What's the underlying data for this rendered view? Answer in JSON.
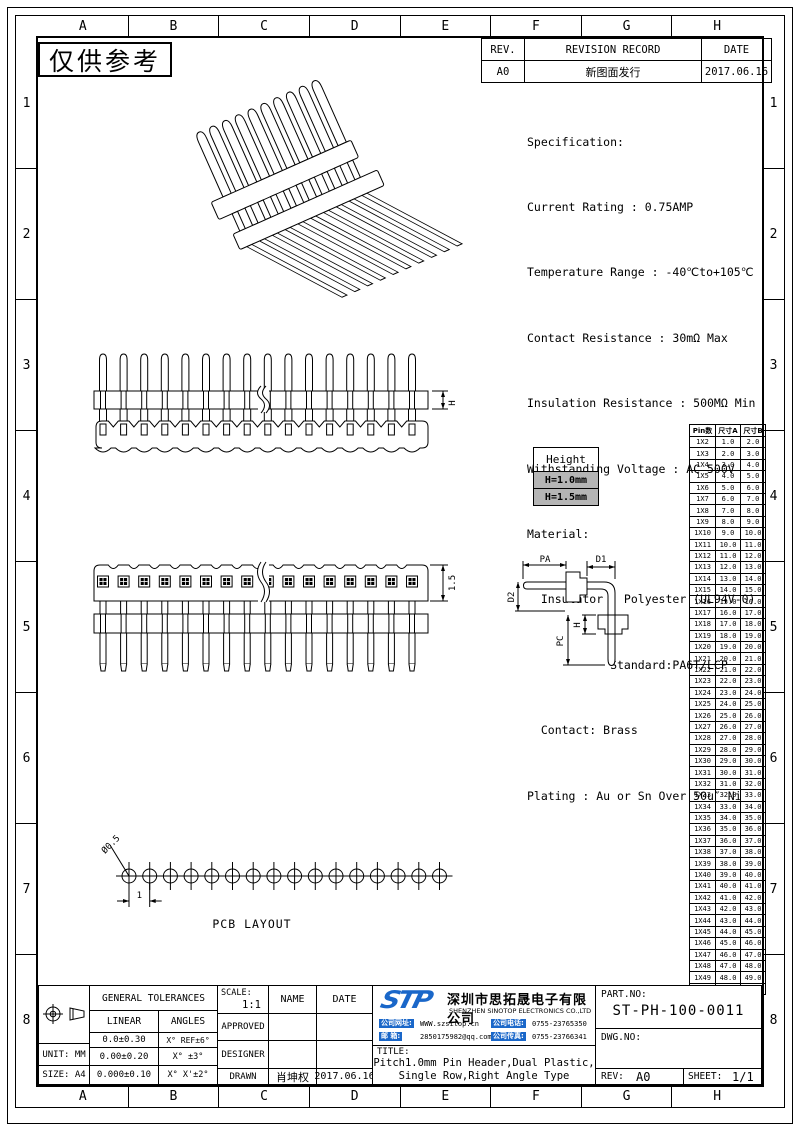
{
  "watermark": "仅供参考",
  "grid": {
    "cols": [
      "A",
      "B",
      "C",
      "D",
      "E",
      "F",
      "G",
      "H"
    ],
    "rows": [
      "1",
      "2",
      "3",
      "4",
      "5",
      "6",
      "7",
      "8"
    ]
  },
  "revision": {
    "rev_header": "REV.",
    "record_header": "REVISION RECORD",
    "date_header": "DATE",
    "rows": [
      {
        "rev": "A0",
        "record": "新图面发行",
        "date": "2017.06.16"
      }
    ]
  },
  "specification": {
    "lines": [
      "Specification:",
      "Current Rating : 0.75AMP",
      "Temperature Range : -40℃to+105℃",
      "Contact Resistance : 30mΩ Max",
      "Insulation Resistance : 500MΩ Min",
      "Withstanding Voltage : AC 500V",
      "Material:",
      "  Insulator : Polyester (UL94V-0)",
      "            Standard:PA6T/LCP",
      "  Contact: Brass",
      "Plating : Au or Sn Over 50u″ Ni"
    ]
  },
  "height_box": {
    "title": "Height",
    "options": [
      "H=1.0mm",
      "H=1.5mm"
    ]
  },
  "size_table": {
    "headers": [
      "Pin数",
      "尺寸A",
      "尺寸B"
    ],
    "rows": [
      [
        "1X2",
        "1.0",
        "2.0"
      ],
      [
        "1X3",
        "2.0",
        "3.0"
      ],
      [
        "1X4",
        "3.0",
        "4.0"
      ],
      [
        "1X5",
        "4.0",
        "5.0"
      ],
      [
        "1X6",
        "5.0",
        "6.0"
      ],
      [
        "1X7",
        "6.0",
        "7.0"
      ],
      [
        "1X8",
        "7.0",
        "8.0"
      ],
      [
        "1X9",
        "8.0",
        "9.0"
      ],
      [
        "1X10",
        "9.0",
        "10.0"
      ],
      [
        "1X11",
        "10.0",
        "11.0"
      ],
      [
        "1X12",
        "11.0",
        "12.0"
      ],
      [
        "1X13",
        "12.0",
        "13.0"
      ],
      [
        "1X14",
        "13.0",
        "14.0"
      ],
      [
        "1X15",
        "14.0",
        "15.0"
      ],
      [
        "1X16",
        "15.0",
        "16.0"
      ],
      [
        "1X17",
        "16.0",
        "17.0"
      ],
      [
        "1X18",
        "17.0",
        "18.0"
      ],
      [
        "1X19",
        "18.0",
        "19.0"
      ],
      [
        "1X20",
        "19.0",
        "20.0"
      ],
      [
        "1X21",
        "20.0",
        "21.0"
      ],
      [
        "1X22",
        "21.0",
        "22.0"
      ],
      [
        "1X23",
        "22.0",
        "23.0"
      ],
      [
        "1X24",
        "23.0",
        "24.0"
      ],
      [
        "1X25",
        "24.0",
        "25.0"
      ],
      [
        "1X26",
        "25.0",
        "26.0"
      ],
      [
        "1X27",
        "26.0",
        "27.0"
      ],
      [
        "1X28",
        "27.0",
        "28.0"
      ],
      [
        "1X29",
        "28.0",
        "29.0"
      ],
      [
        "1X30",
        "29.0",
        "30.0"
      ],
      [
        "1X31",
        "30.0",
        "31.0"
      ],
      [
        "1X32",
        "31.0",
        "32.0"
      ],
      [
        "1X33",
        "32.0",
        "33.0"
      ],
      [
        "1X34",
        "33.0",
        "34.0"
      ],
      [
        "1X35",
        "34.0",
        "35.0"
      ],
      [
        "1X36",
        "35.0",
        "36.0"
      ],
      [
        "1X37",
        "36.0",
        "37.0"
      ],
      [
        "1X38",
        "37.0",
        "38.0"
      ],
      [
        "1X39",
        "38.0",
        "39.0"
      ],
      [
        "1X40",
        "39.0",
        "40.0"
      ],
      [
        "1X41",
        "40.0",
        "41.0"
      ],
      [
        "1X42",
        "41.0",
        "42.0"
      ],
      [
        "1X43",
        "42.0",
        "43.0"
      ],
      [
        "1X44",
        "43.0",
        "44.0"
      ],
      [
        "1X45",
        "44.0",
        "45.0"
      ],
      [
        "1X46",
        "45.0",
        "46.0"
      ],
      [
        "1X47",
        "46.0",
        "47.0"
      ],
      [
        "1X48",
        "47.0",
        "48.0"
      ],
      [
        "1X49",
        "48.0",
        "49.0"
      ],
      [
        "1X50",
        "49.0",
        "50.0"
      ]
    ]
  },
  "dims": {
    "pa": "PA",
    "d1": "D1",
    "d2": "D2",
    "h": "H",
    "pc": "PC",
    "front_h": "H",
    "top_h": "1.5",
    "hole_dia": "Ø0.5",
    "pitch": "1",
    "pcb_caption": "PCB LAYOUT"
  },
  "title_block": {
    "tolerances": {
      "header": "GENERAL TOLERANCES",
      "linear": "LINEAR",
      "angles": "ANGLES",
      "linear_values": [
        "0.0±0.30",
        "0.00±0.20",
        "0.000±0.10"
      ],
      "angle_values": [
        "X° REF±6°",
        "X° ±3°",
        "X° X'±2°"
      ],
      "unit": "UNIT: MM",
      "size": "SIZE: A4"
    },
    "approval": {
      "scale_label": "SCALE:",
      "scale": "1:1",
      "name_header": "NAME",
      "date_header": "DATE",
      "approved_label": "APPROVED",
      "designer_label": "DESIGNER",
      "drawn_label": "DRAWN",
      "drawn_name": "肖坤权",
      "drawn_date": "2017.06.16"
    },
    "company": {
      "logo": "STP",
      "name_cn": "深圳市思拓晟电子有限公司",
      "name_en": "SHENZHEN SINOTOP ELECTRONICS CO.,LTD",
      "website_label": "公司网址:",
      "website": "WWW.szsitop.cn",
      "email_label": "邮  箱:",
      "email": "2850175982@qq.com",
      "phone_label": "公司电话:",
      "phone": "0755-23765350",
      "fax_label": "公司传真:",
      "fax": "0755-23766341"
    },
    "drawing": {
      "title_label": "TITLE:",
      "title_line1": "Pitch1.0mm Pin Header,Dual Plastic,",
      "title_line2": "Single Row,Right Angle Type",
      "part_label": "PART.NO:",
      "part_no": "ST-PH-100-0011",
      "dwg_label": "DWG.NO:",
      "dwg_no": "",
      "rev_label": "REV:",
      "rev": "A0",
      "sheet_label": "SHEET:",
      "sheet": "1/1"
    }
  }
}
